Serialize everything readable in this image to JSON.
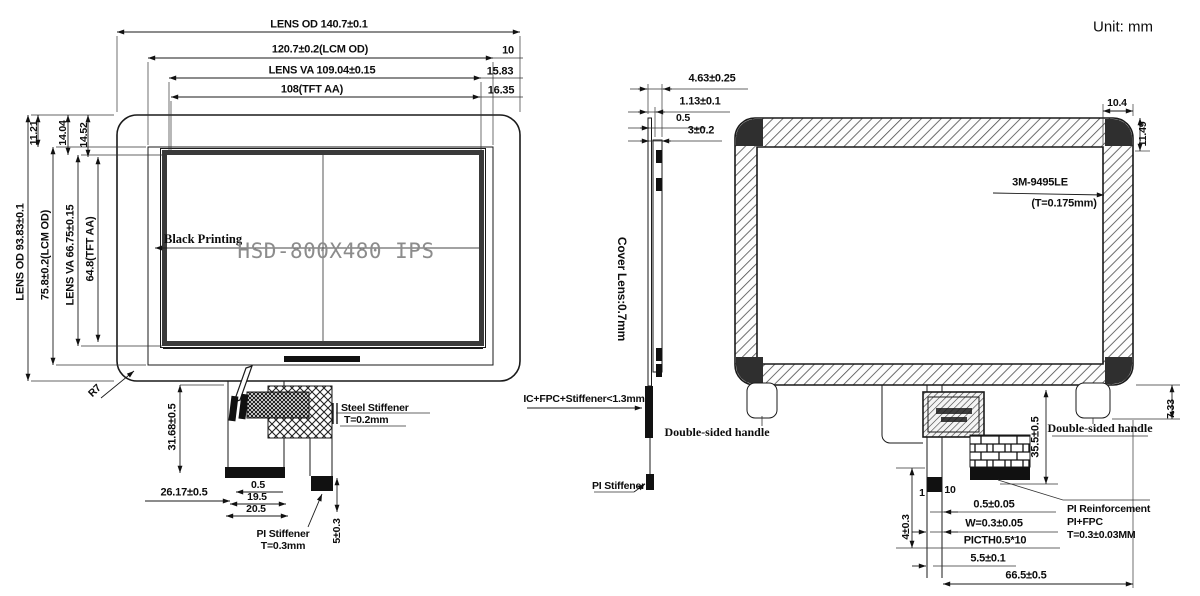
{
  "unit": "Unit: mm",
  "front": {
    "dim_lens_od_w": "LENS OD 140.7±0.1",
    "dim_lcm_w": "120.7±0.2(LCM OD)",
    "dim_10": "10",
    "dim_va_w": "LENS VA 109.04±0.15",
    "dim_1583": "15.83",
    "dim_aa_w": "108(TFT AA)",
    "dim_1635": "16.35",
    "dim_lens_od_h": "LENS OD 93.83±0.1",
    "dim_lcm_h": "75.8±0.2(LCM OD)",
    "dim_va_h": "LENS VA 66.75±0.15",
    "dim_aa_h": "64.8(TFT AA)",
    "dim_1121": "11.21",
    "dim_1404": "14.04",
    "dim_1452": "14.52",
    "black_printing": "Black Printing",
    "model": "HSD-800X480 IPS",
    "radius": "R7",
    "dim_3168": "31.68±0.5",
    "dim_2617": "26.17±0.5",
    "dim_05": "0.5",
    "dim_195": "19.5",
    "dim_205": "20.5",
    "steel_stiffener": "Steel Stiffener",
    "steel_thickness": "T=0.2mm",
    "pi_stiffener": "PI Stiffener",
    "pi_thickness": "T=0.3mm",
    "dim_5": "5±0.3"
  },
  "side": {
    "dim_463": "4.63±0.25",
    "dim_113": "1.13±0.1",
    "dim_05": "0.5",
    "dim_3": "3±0.2",
    "cover_lens": "Cover Lens:0.7mm",
    "stack": "IC+FPC+Stiffener<1.3mm",
    "pi_stiffener": "PI Stiffener"
  },
  "back": {
    "dim_104": "10.4",
    "dim_1149": "11.49",
    "adhesive": "3M-9495LE",
    "adhesive_thickness": "(T=0.175mm)",
    "handle_left": "Double-sided handle",
    "handle_right": "Double-sided handle",
    "dim_733": "7.33",
    "dim_355": "35.5±0.5",
    "dim_1": "1",
    "dim_10": "10",
    "dim_4": "4±0.3",
    "dim_0505": "0.5±0.05",
    "dim_w03": "W=0.3±0.05",
    "dim_pitch": "PICTH0.5*10",
    "dim_55": "5.5±0.1",
    "dim_665": "66.5±0.5",
    "pi_reinforcement": "PI Reinforcement",
    "pi_fpc": "PI+FPC",
    "pi_fpc_thickness": "T=0.3±0.03MM"
  }
}
